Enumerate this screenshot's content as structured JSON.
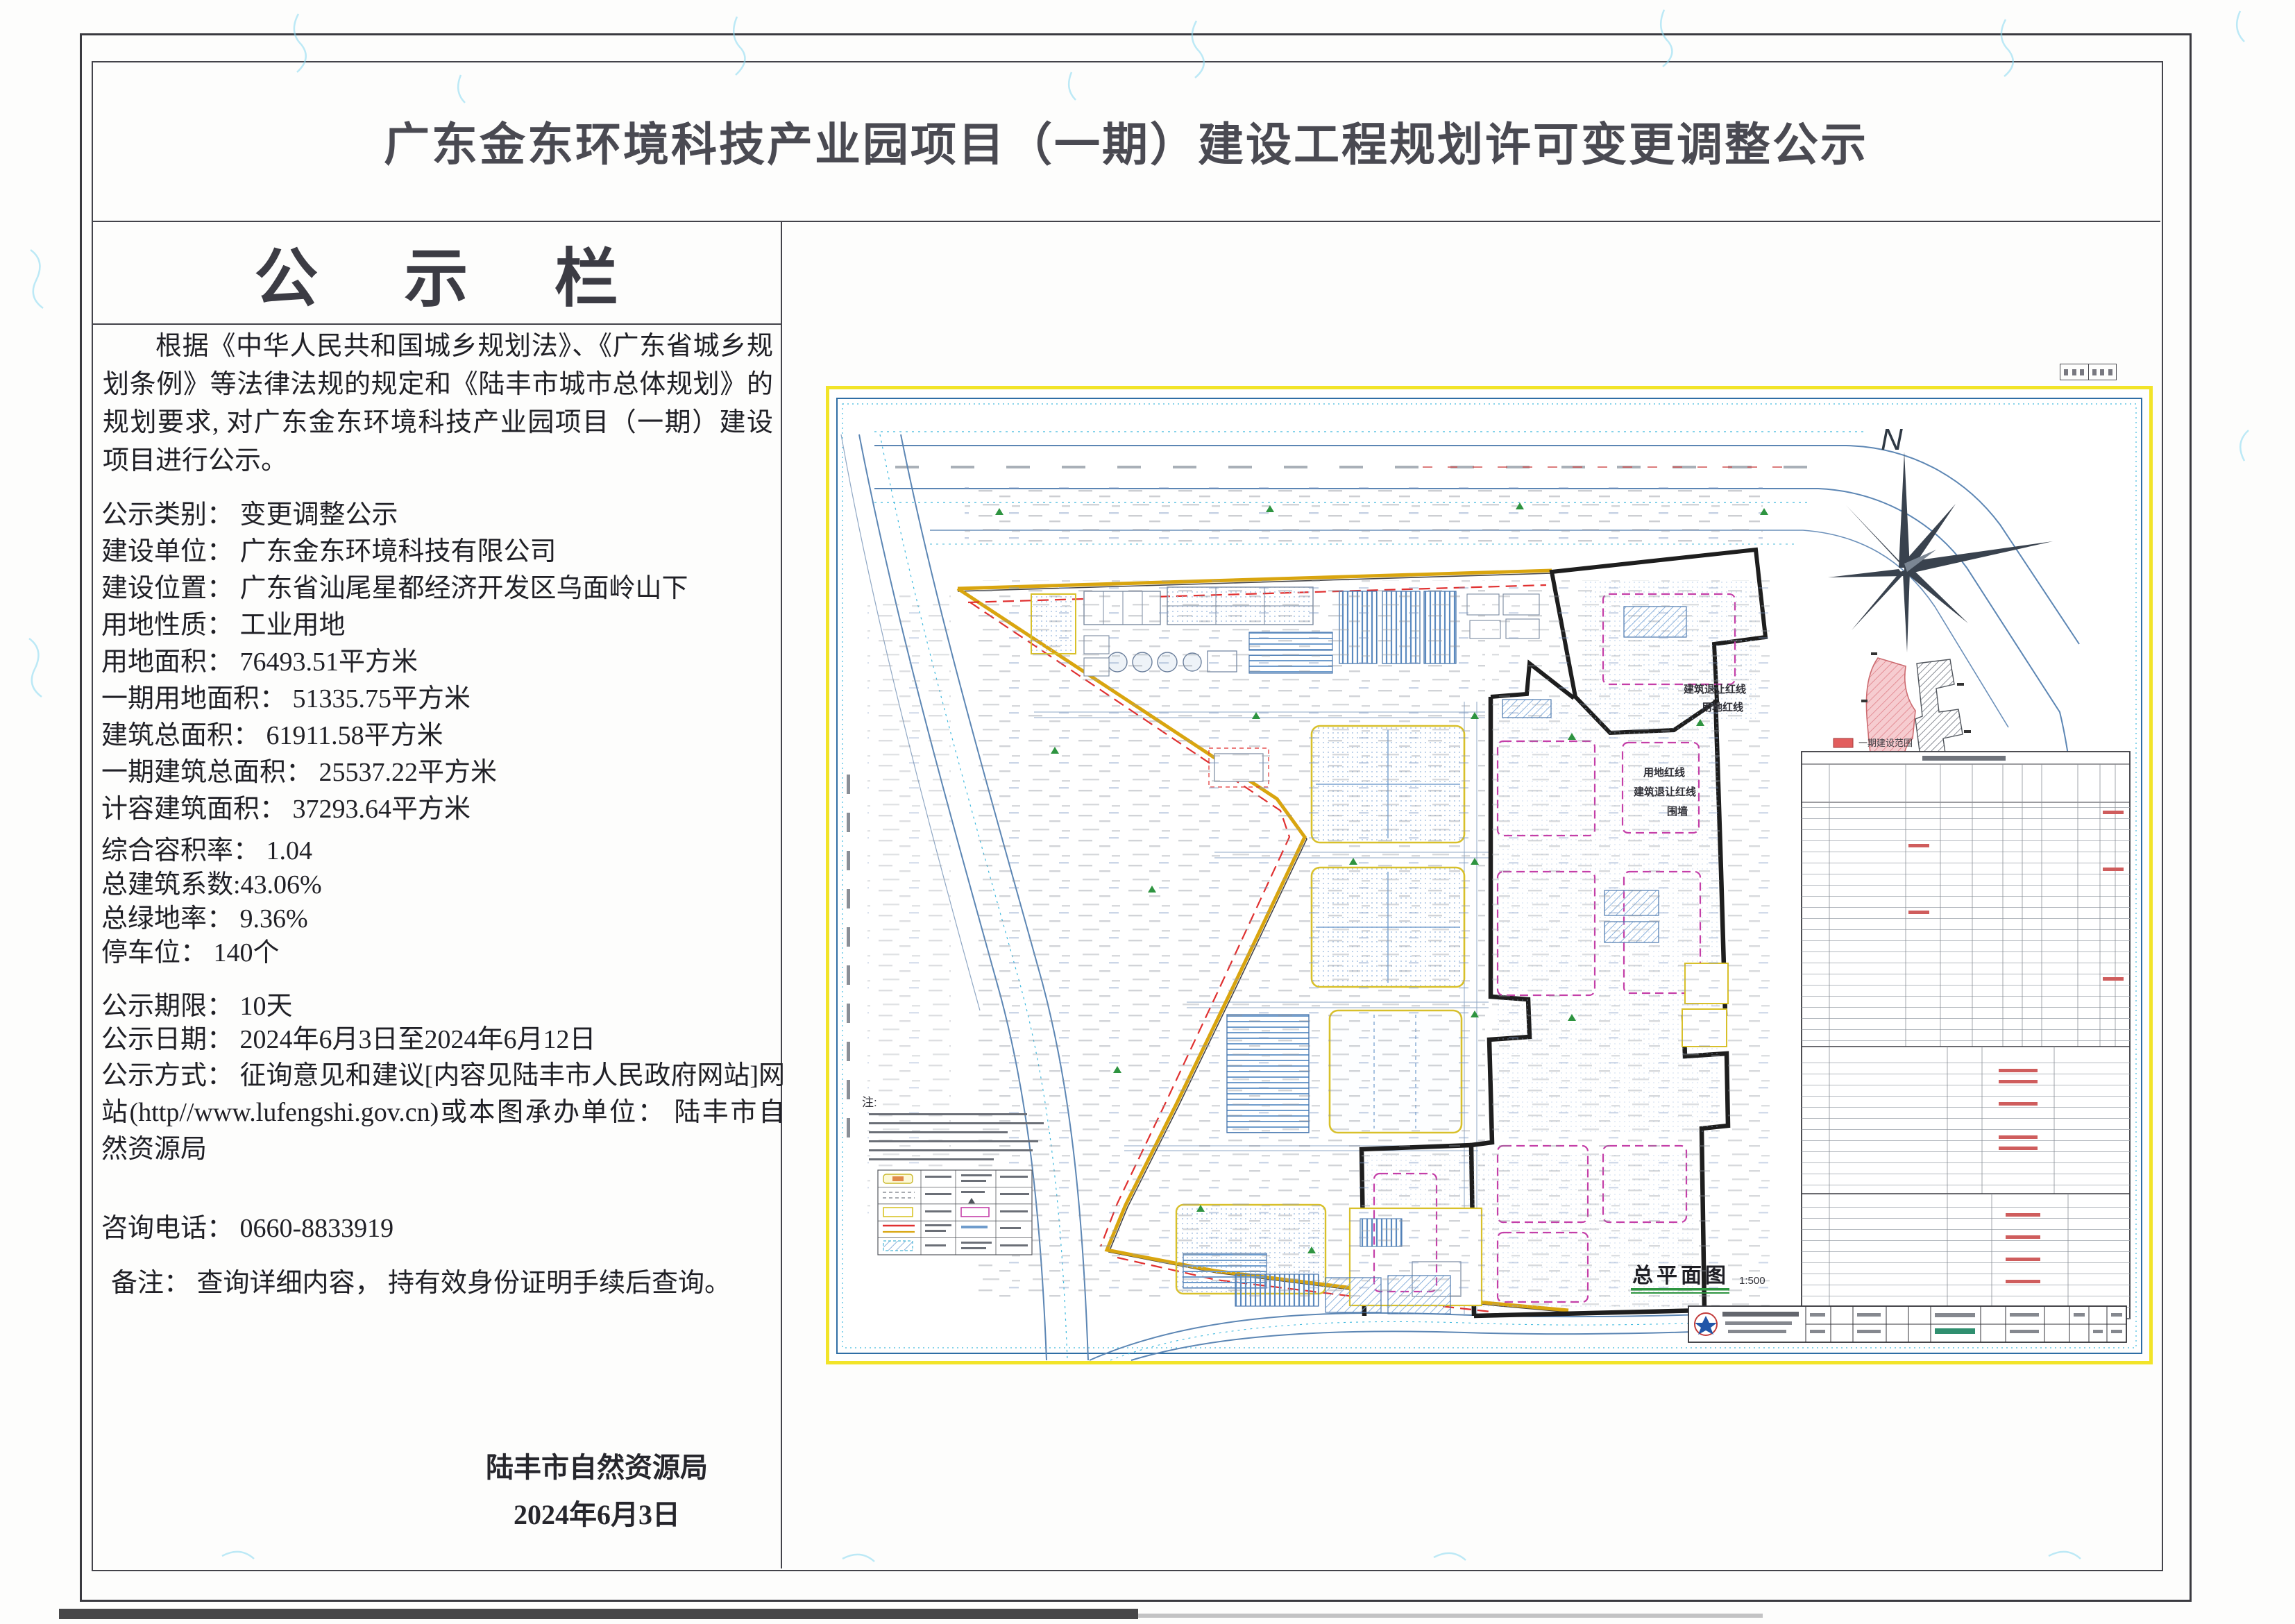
{
  "page": {
    "title": "广东金东环境科技产业园项目（一期）建设工程规划许可变更调整公示"
  },
  "notice": {
    "heading": "公 示 栏",
    "intro": "根据《中华人民共和国城乡规划法》、《广东省城乡规划条例》等法律法规的规定和《陆丰市城市总体规划》的规划要求, 对广东金东环境科技产业园项目（一期）建设项目进行公示。",
    "lines": [
      "公示类别： 变更调整公示",
      "建设单位： 广东金东环境科技有限公司",
      "建设位置： 广东省汕尾星都经济开发区乌面岭山下",
      "用地性质： 工业用地",
      "用地面积： 76493.51平方米",
      "一期用地面积： 51335.75平方米",
      "建筑总面积： 61911.58平方米",
      "一期建筑总面积： 25537.22平方米",
      "计容建筑面积： 37293.64平方米"
    ],
    "lines_b": [
      "综合容积率： 1.04",
      "总建筑系数:43.06%",
      "总绿地率： 9.36%",
      "停车位： 140个"
    ],
    "lines_c": [
      "公示期限： 10天",
      "公示日期： 2024年6月3日至2024年6月12日"
    ],
    "method_line": "公示方式： 征询意见和建议[内容见陆丰市人民政府网站]网站(http//www.lufengshi.gov.cn)或本图承办单位： 陆丰市自然资源局",
    "phone_line": "咨询电话：  0660-8833919",
    "remark_line": "备注： 查询详细内容， 持有效身份证明手续后查询。",
    "signature": "陆丰市自然资源局",
    "date": "2024年6月3日"
  },
  "drawing": {
    "north_label": "N",
    "plan_title": "总平面图",
    "plan_scale": "1:500",
    "legend": {
      "phase1": "一期建设范围",
      "phase2": "二期建设范围"
    },
    "labels": {
      "red_line": "用地红线",
      "setback_line": "建筑退让红线",
      "wall": "围墙",
      "notes": "注:"
    }
  }
}
